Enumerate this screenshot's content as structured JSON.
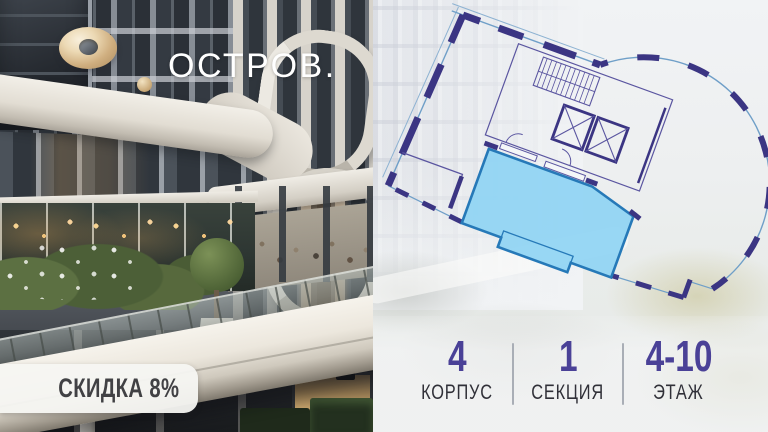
{
  "brand": {
    "logo_text": "ОСТРОВ.",
    "logo_mark": "gold-ring-with-dot",
    "logo_gold": "#c9aa7c"
  },
  "badge": {
    "label": "СКИДКА 8%"
  },
  "stats": {
    "items": [
      {
        "value": "4",
        "label": "КОРПУС"
      },
      {
        "value": "1",
        "label": "СЕКЦИЯ"
      },
      {
        "value": "4-10",
        "label": "ЭТАЖ"
      }
    ],
    "number_color": "#4a4197",
    "label_color": "#303038",
    "divider_color": "#a9aeb6"
  },
  "floor_plan": {
    "kind": "residential-floor-plan",
    "rotation_deg": 20,
    "wall_color": "#3b3583",
    "thin_line_color": "#5a55a0",
    "glazing_line_color": "#6f9fc8",
    "highlighted_unit_fill": "#8fd4f3",
    "highlighted_unit_border": "#2679b8",
    "highlighted_unit": true
  }
}
